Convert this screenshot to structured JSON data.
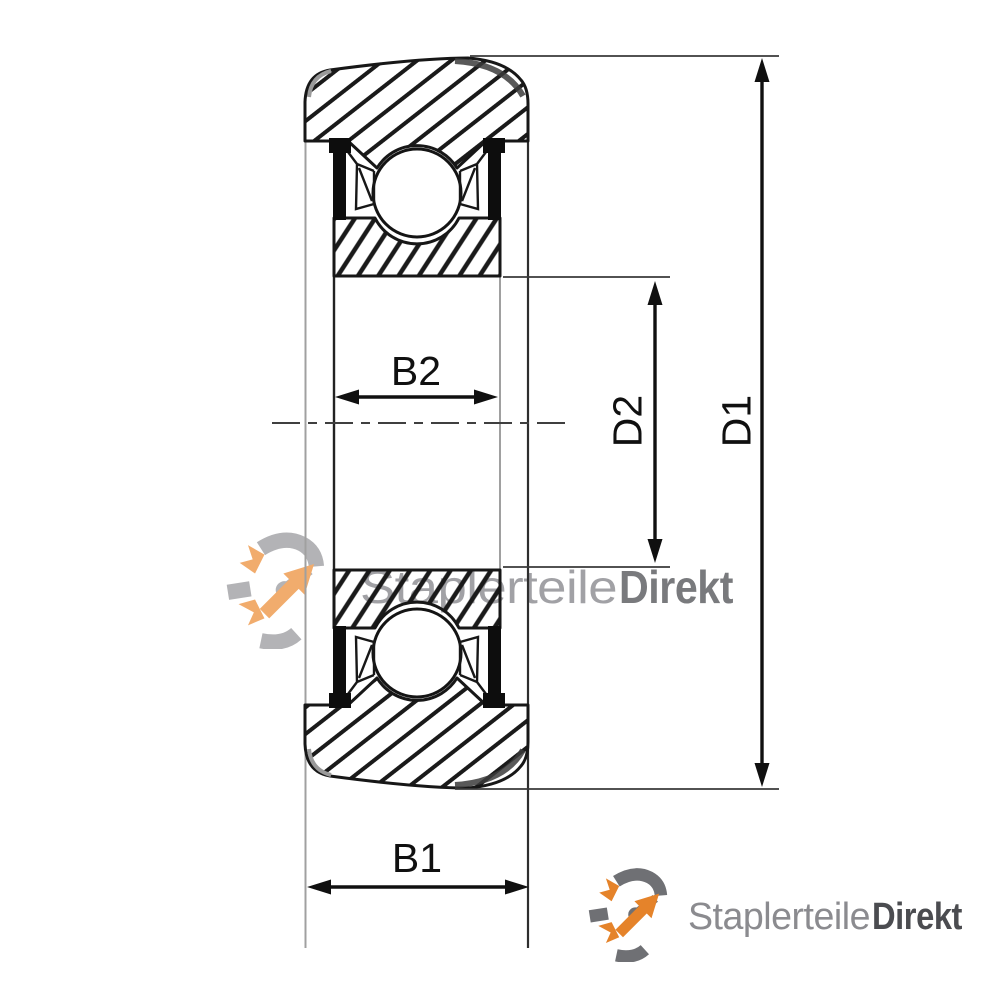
{
  "drawing": {
    "type": "bearing-cross-section-technical-drawing",
    "labels": {
      "outer_width": "B1",
      "inner_width": "B2",
      "outer_diameter": "D1",
      "inner_diameter": "D2"
    }
  },
  "watermark": {
    "icon": "gear-arrow-icon",
    "brand_regular": "Staplerteile",
    "brand_bold": "Direkt"
  },
  "footer_logo": {
    "icon": "gear-arrow-icon",
    "brand_regular": "Staplerteile",
    "brand_bold": "Direkt"
  },
  "colors": {
    "line": "#141414",
    "guide_gray": "#a0a0a0",
    "brand_orange": "#e5832a",
    "brand_gray": "#6f7074",
    "watermark_text": "#9b9b9e",
    "background": "#ffffff"
  }
}
